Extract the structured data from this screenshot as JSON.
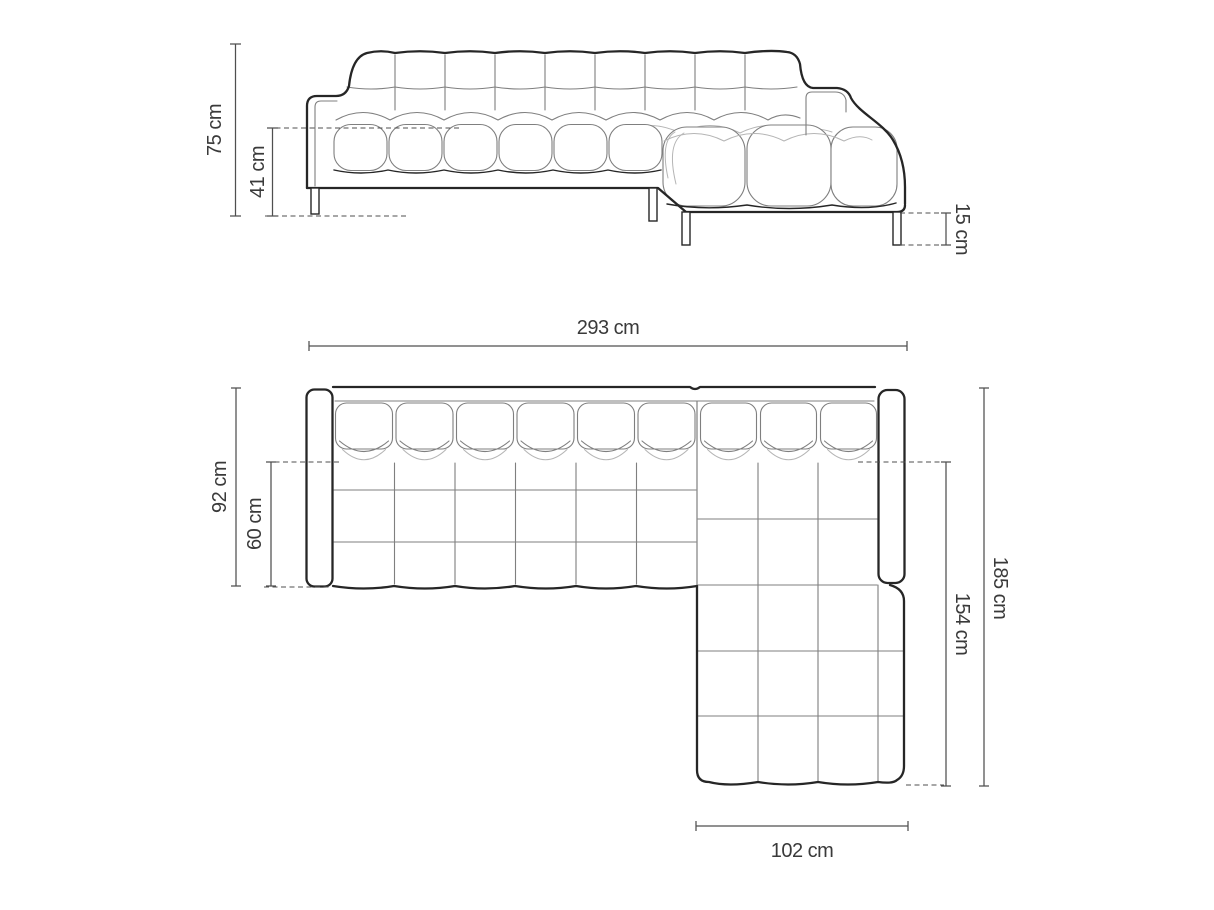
{
  "colors": {
    "paper": "#ffffff",
    "ink": "#262626",
    "line": "#7f7f7f",
    "line2": "#b5b5b5",
    "dim": "#4f4f4f",
    "txt": "#3a3a3a"
  },
  "front_view": {
    "dims": {
      "total_height": "75 cm",
      "seat_height": "41 cm",
      "leg_height": "15 cm"
    }
  },
  "plan_view": {
    "dims": {
      "total_width": "293 cm",
      "total_depth": "92 cm",
      "seat_depth": "60 cm",
      "total_length": "185 cm",
      "chaise_length": "154 cm",
      "chaise_width": "102 cm"
    }
  }
}
